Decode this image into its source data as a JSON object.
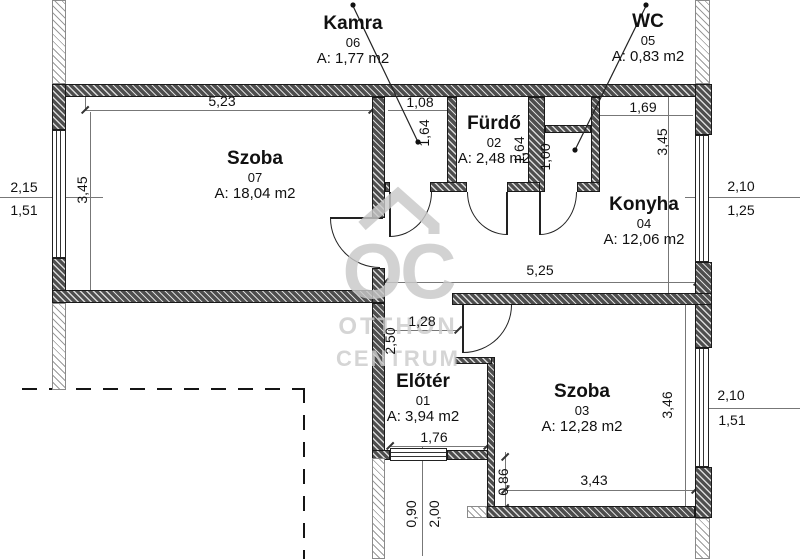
{
  "watermark": {
    "monogram": "OC",
    "line1": "OTTHON",
    "line2": "CENTRUM",
    "color": "#c9c9c9"
  },
  "colors": {
    "wall_dark": "#4e4e4e",
    "wall_light_stripe": "#9a9a9a",
    "line": "#222222",
    "background": "#ffffff"
  },
  "rooms": [
    {
      "name": "Kamra",
      "number": "06",
      "area": "A: 1,77 m2"
    },
    {
      "name": "WC",
      "number": "05",
      "area": "A: 0,83 m2"
    },
    {
      "name": "Szoba",
      "number": "07",
      "area": "A: 18,04 m2"
    },
    {
      "name": "Fürdő",
      "number": "02",
      "area": "A: 2,48 m2"
    },
    {
      "name": "Konyha",
      "number": "04",
      "area": "A: 12,06 m2"
    },
    {
      "name": "Előtér",
      "number": "01",
      "area": "A: 3,94 m2"
    },
    {
      "name": "Szoba",
      "number": "03",
      "area": "A: 12,28 m2"
    }
  ],
  "dimensions": {
    "szoba07_width": "5,23",
    "szoba07_depth": "3,45",
    "left_window_upper": "2,15",
    "left_window_lower": "1,51",
    "kamra_width": "1,08",
    "kamra_depth": "1,64",
    "furdo_depth": "1,64",
    "wc_depth": "1,00",
    "konyha_top_width": "1,69",
    "konyha_depth": "3,45",
    "konyha_window_upper": "2,10",
    "konyha_window_lower": "1,25",
    "hall_width": "5,25",
    "eloter_top_width": "1,28",
    "eloter_depth": "2,50",
    "eloter_bottom_width": "1,76",
    "szoba03_depth": "3,46",
    "szoba03_width": "3,43",
    "szoba03_offset": "0,86",
    "szoba03_window_upper": "2,10",
    "szoba03_window_lower": "1,51",
    "entrance_width": "0,90",
    "entrance_depth": "2,00"
  }
}
